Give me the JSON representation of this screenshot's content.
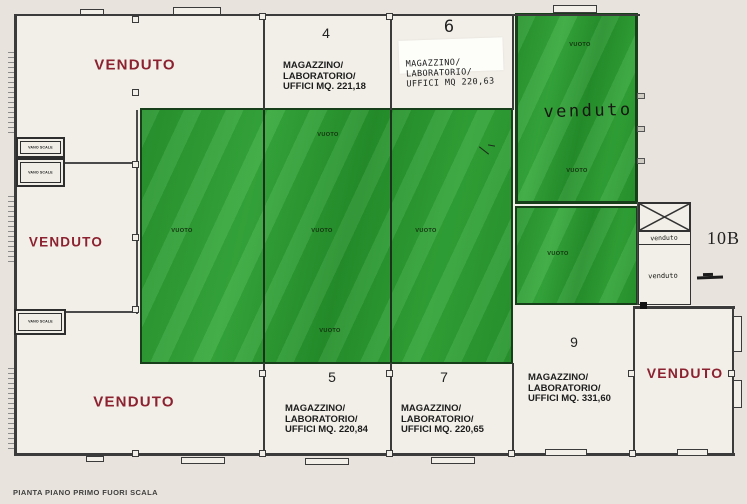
{
  "plan": {
    "caption": "PIANTA PIANO PRIMO FUORI SCALA",
    "external_unit_label": "10B"
  },
  "labels": {
    "vuoto": "VUOTO",
    "stairwell": "VANO SCALE",
    "sold_printed": "VENDUTO",
    "sold_handwritten": "venduto"
  },
  "units": [
    {
      "number": "4",
      "line1": "MAGAZZINO/",
      "line2": "LABORATORIO/",
      "line3": "UFFICI MQ. 221,18"
    },
    {
      "number": "6",
      "line1": "MAGAZZINO/",
      "line2": "LABORATORIO/",
      "line3": "UFFICI MQ 220,63"
    },
    {
      "number": "5",
      "line1": "MAGAZZINO/",
      "line2": "LABORATORIO/",
      "line3": "UFFICI MQ. 220,84"
    },
    {
      "number": "7",
      "line1": "MAGAZZINO/",
      "line2": "LABORATORIO/",
      "line3": "UFFICI MQ. 220,65"
    },
    {
      "number": "9",
      "line1": "MAGAZZINO/",
      "line2": "LABORATORIO/",
      "line3": "UFFICI MQ. 331,60"
    }
  ],
  "colors": {
    "highlight_green": "#2f9e35",
    "sold_red": "#8c2130",
    "wall_gray": "#3b3b3b",
    "paper": "#e8e4dd"
  }
}
